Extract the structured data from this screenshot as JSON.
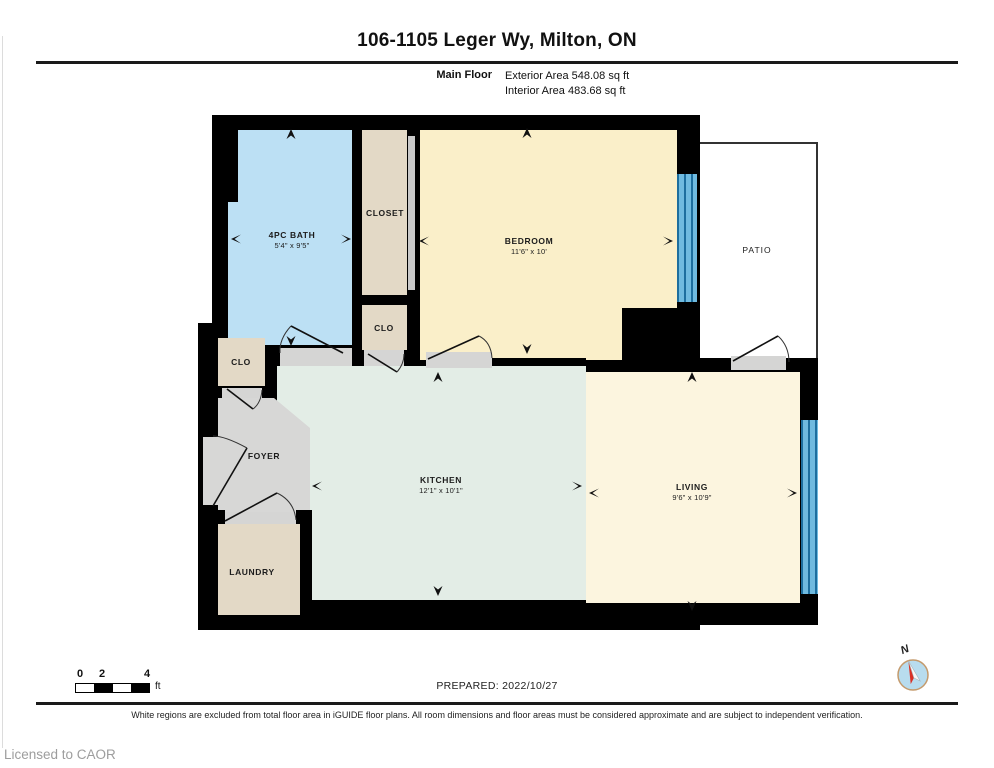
{
  "title": "106-1105 Leger Wy, Milton, ON",
  "floor": {
    "name": "Main Floor",
    "exterior_area": "Exterior Area 548.08 sq ft",
    "interior_area": "Interior Area 483.68 sq ft"
  },
  "rooms": {
    "bath": {
      "label": "4PC BATH",
      "dims": "5'4\" x 9'5\""
    },
    "closet": {
      "label": "CLOSET"
    },
    "clo_mid": {
      "label": "CLO"
    },
    "clo_left": {
      "label": "CLO"
    },
    "bedroom": {
      "label": "BEDROOM",
      "dims": "11'6\" x 10'"
    },
    "patio": {
      "label": "PATIO"
    },
    "foyer": {
      "label": "FOYER"
    },
    "kitchen": {
      "label": "KITCHEN",
      "dims": "12'1\" x 10'1\""
    },
    "living": {
      "label": "LIVING",
      "dims": "9'6\" x 10'9\""
    },
    "laundry": {
      "label": "LAUNDRY"
    }
  },
  "scale_bar": {
    "ticks": [
      "0",
      "2",
      "4"
    ],
    "unit": "ft"
  },
  "prepared": "PREPARED: 2022/10/27",
  "compass": {
    "label": "N"
  },
  "disclaimer": "White regions are excluded from total floor area in iGUIDE floor plans. All room dimensions and floor areas must be considered approximate and are subject to independent verification.",
  "license": "Licensed to CAOR",
  "colors": {
    "wall": "#000000",
    "bath": "#BCE0F4",
    "bedroom": "#FAEFC9",
    "living": "#FCF5DF",
    "kitchen": "#E3EDE6",
    "closet_beige": "#E3D9C6",
    "foyer_gray": "#D7D7D6",
    "window_blue": "#5FB2DC"
  }
}
